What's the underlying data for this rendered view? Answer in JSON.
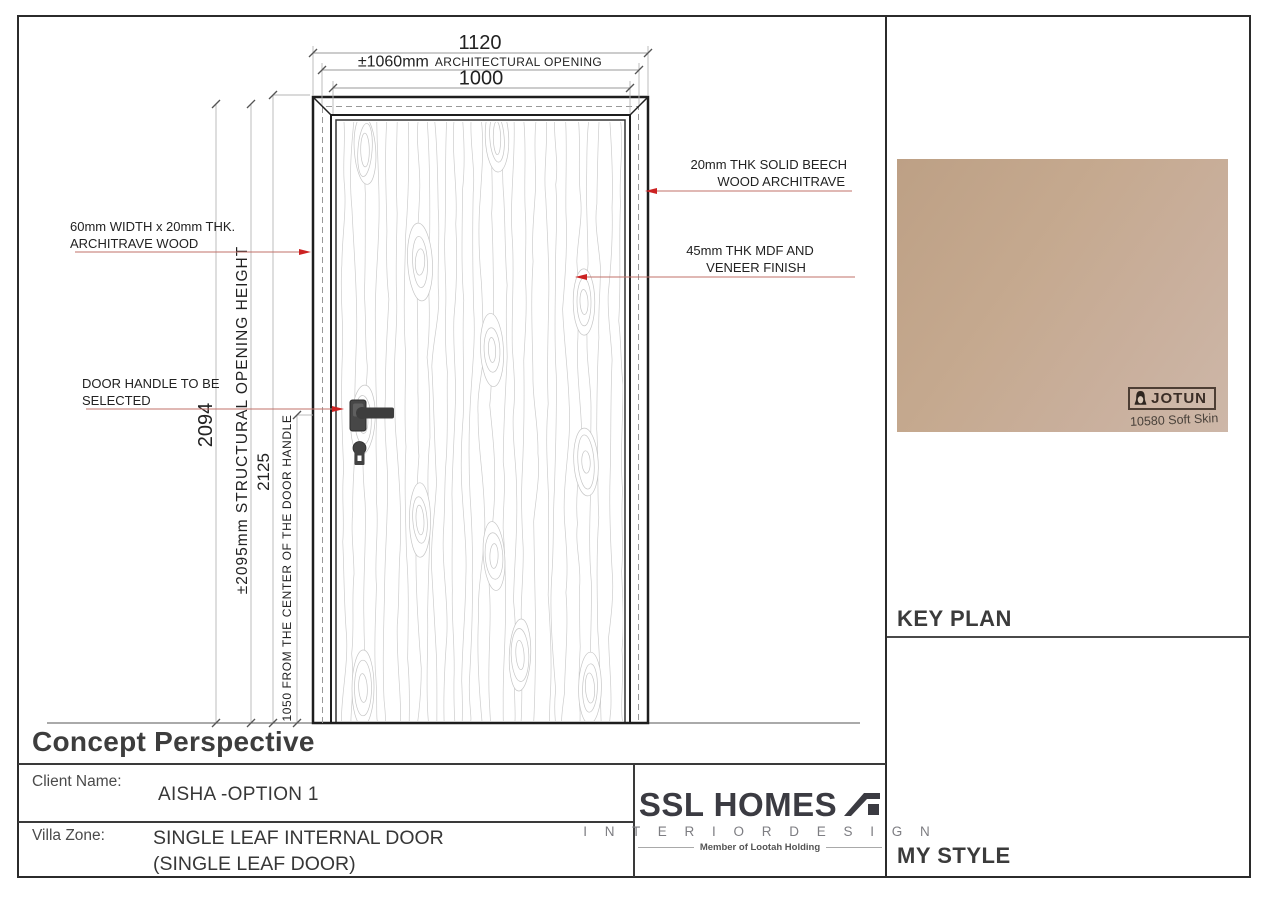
{
  "sheet": {
    "title": "Concept Perspective",
    "client_label": "Client Name:",
    "client_value": "AISHA -OPTION 1",
    "zone_label": "Villa Zone:",
    "zone_value_line1": "SINGLE LEAF INTERNAL DOOR",
    "zone_value_line2": "(SINGLE LEAF DOOR)"
  },
  "logo": {
    "name": "SSL HOMES",
    "subtitle": "I N T E R I O R   D E S I G N",
    "tagline": "Member of Lootah Holding"
  },
  "side_panel": {
    "key_plan_label": "KEY PLAN",
    "my_style_label": "MY STYLE",
    "swatch": {
      "brand": "JOTUN",
      "color_code": "10580 Soft Skin",
      "color_hex": "#c3a98f"
    }
  },
  "drawing": {
    "dimensions": {
      "top_overall": "1120",
      "top_arch_value": "±1060mm",
      "top_arch_label": "ARCHITECTURAL OPENING",
      "top_leaf": "1000",
      "left_height": "2094",
      "left_structural": "±2095mm STRUCTURAL OPENING HEIGHT",
      "left_frame_height": "2125",
      "left_handle": "1050 FROM THE CENTER OF THE DOOR HANDLE"
    },
    "annotations": {
      "architrave_left_1": "60mm WIDTH x 20mm THK.",
      "architrave_left_2": "ARCHITRAVE WOOD",
      "handle_1": "DOOR HANDLE TO BE",
      "handle_2": "SELECTED",
      "architrave_right_1": "20mm THK SOLID BEECH",
      "architrave_right_2": "WOOD ARCHITRAVE",
      "leaf_1": "45mm THK MDF AND",
      "leaf_2": "VENEER  FINISH"
    },
    "colors": {
      "leader_line": "#c0706a",
      "leader_arrow": "#cc2222",
      "drawing_line": "#232323",
      "dim_line": "#9a9a9a"
    }
  }
}
